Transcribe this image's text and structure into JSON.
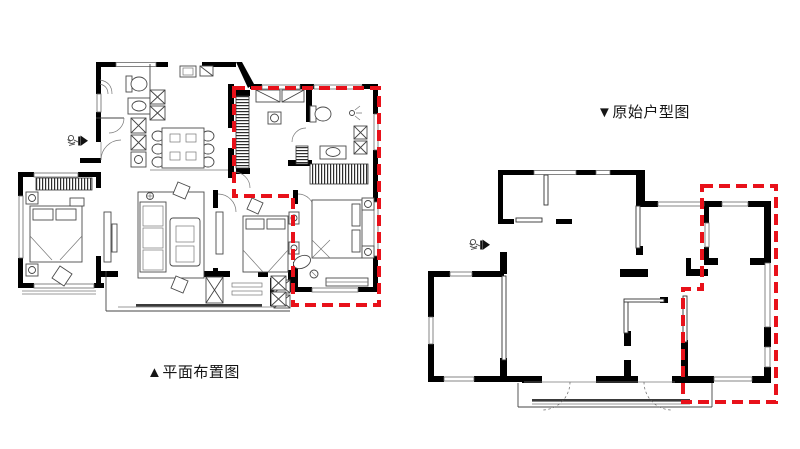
{
  "page": {
    "background": "#ffffff",
    "width": 800,
    "height": 449
  },
  "colors": {
    "wall_black": "#000000",
    "drawing_line": "#4a4a4a",
    "highlight_red": "#e8111a"
  },
  "plans": {
    "left": {
      "label": "▲平面布置图",
      "highlight_color": "#e8111a",
      "highlight_style": "dashed"
    },
    "right": {
      "label": "▼原始户型图",
      "highlight_color": "#e8111a",
      "highlight_style": "dashed"
    }
  },
  "icons": {
    "entry_figure": "person-with-arrow-entry-icon"
  }
}
